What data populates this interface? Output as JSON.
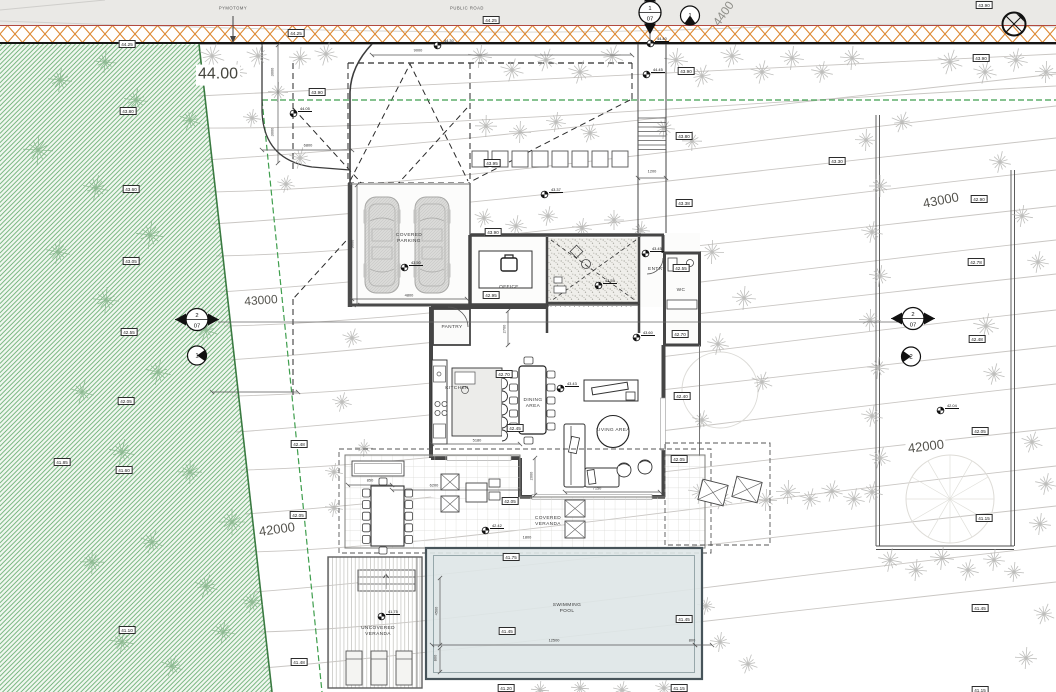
{
  "road": {
    "label_top": "PYMOTOMY",
    "label_public_road": "PUBLIC ROAD"
  },
  "contour_labels": [
    {
      "text": "44.00",
      "x": 218,
      "y": 75,
      "size": 16,
      "rot": 0,
      "color": "#46463f",
      "bg": true
    },
    {
      "text": "43000",
      "x": 261,
      "y": 301,
      "size": 12,
      "rot": -4,
      "color": "#55544e",
      "bg": true
    },
    {
      "text": "43000",
      "x": 941,
      "y": 201,
      "size": 13,
      "rot": -11,
      "color": "#55544e",
      "bg": true
    },
    {
      "text": "42000",
      "x": 277,
      "y": 530,
      "size": 13,
      "rot": -8,
      "color": "#55544e",
      "bg": true
    },
    {
      "text": "42000",
      "x": 926,
      "y": 447,
      "size": 13,
      "rot": -7,
      "color": "#55544e",
      "bg": true
    },
    {
      "text": "4400",
      "x": 724,
      "y": 14,
      "size": 12,
      "rot": -55,
      "color": "#8e8e88",
      "bg": false
    }
  ],
  "rooms": [
    {
      "label": "COVERED\nPARKING",
      "x": 409,
      "y": 239
    },
    {
      "label": "OFFICE",
      "x": 509,
      "y": 288
    },
    {
      "label": "ENTRY",
      "x": 657,
      "y": 270
    },
    {
      "label": "WC",
      "x": 681,
      "y": 291
    },
    {
      "label": "PANTRY",
      "x": 452,
      "y": 328
    },
    {
      "label": "KITCHEN",
      "x": 457,
      "y": 389
    },
    {
      "label": "DINING\nAREA",
      "x": 533,
      "y": 404
    },
    {
      "label": "LIVING AREA",
      "x": 613,
      "y": 431
    },
    {
      "label": "COVERED\nVERANDA",
      "x": 548,
      "y": 522
    },
    {
      "label": "SWIMMING\nPOOL",
      "x": 567,
      "y": 609
    },
    {
      "label": "UNCOVERED\nVERANDA",
      "x": 378,
      "y": 632
    }
  ],
  "spot_elevations": [
    {
      "v": "44.30",
      "x": 437,
      "y": 45
    },
    {
      "v": "44.40",
      "x": 650,
      "y": 43
    },
    {
      "v": "44.45",
      "x": 646,
      "y": 74
    },
    {
      "v": "44.05",
      "x": 293,
      "y": 113
    },
    {
      "v": "43.37",
      "x": 544,
      "y": 194
    },
    {
      "v": "43.50",
      "x": 404,
      "y": 267
    },
    {
      "v": "43.45",
      "x": 645,
      "y": 253
    },
    {
      "v": "43.55",
      "x": 598,
      "y": 285
    },
    {
      "v": "43.60",
      "x": 636,
      "y": 337
    },
    {
      "v": "43.43",
      "x": 560,
      "y": 388
    },
    {
      "v": "42.42",
      "x": 485,
      "y": 530
    },
    {
      "v": "41.75",
      "x": 381,
      "y": 616
    },
    {
      "v": "42.04",
      "x": 940,
      "y": 410
    }
  ],
  "elevation_markers": [
    {
      "v": "44.25",
      "x": 127,
      "y": 44
    },
    {
      "v": "44.25",
      "x": 296,
      "y": 33
    },
    {
      "v": "44.25",
      "x": 491,
      "y": 20
    },
    {
      "v": "43.90",
      "x": 686,
      "y": 71
    },
    {
      "v": "43.90",
      "x": 981,
      "y": 58
    },
    {
      "v": "43.90",
      "x": 984,
      "y": 5
    },
    {
      "v": "43.80",
      "x": 128,
      "y": 111
    },
    {
      "v": "43.60",
      "x": 131,
      "y": 189
    },
    {
      "v": "43.05",
      "x": 131,
      "y": 261
    },
    {
      "v": "42.55",
      "x": 129,
      "y": 332
    },
    {
      "v": "42.05",
      "x": 126,
      "y": 401
    },
    {
      "v": "41.60",
      "x": 124,
      "y": 470
    },
    {
      "v": "41.10",
      "x": 127,
      "y": 630
    },
    {
      "v": "41.85",
      "x": 62,
      "y": 462
    },
    {
      "v": "43.90",
      "x": 317,
      "y": 92
    },
    {
      "v": "43.95",
      "x": 492,
      "y": 163
    },
    {
      "v": "43.90",
      "x": 493,
      "y": 232
    },
    {
      "v": "42.95",
      "x": 491,
      "y": 295
    },
    {
      "v": "43.80",
      "x": 684,
      "y": 136
    },
    {
      "v": "43.38",
      "x": 684,
      "y": 203
    },
    {
      "v": "42.55",
      "x": 681,
      "y": 268
    },
    {
      "v": "42.70",
      "x": 680,
      "y": 334
    },
    {
      "v": "42.70",
      "x": 504,
      "y": 374
    },
    {
      "v": "42.45",
      "x": 515,
      "y": 428
    },
    {
      "v": "42.40",
      "x": 682,
      "y": 396
    },
    {
      "v": "42.05",
      "x": 679,
      "y": 459
    },
    {
      "v": "42.05",
      "x": 510,
      "y": 501
    },
    {
      "v": "41.75",
      "x": 511,
      "y": 557
    },
    {
      "v": "41.45",
      "x": 507,
      "y": 631
    },
    {
      "v": "41.45",
      "x": 684,
      "y": 619
    },
    {
      "v": "41.20",
      "x": 506,
      "y": 688
    },
    {
      "v": "41.15",
      "x": 679,
      "y": 688
    },
    {
      "v": "43.30",
      "x": 837,
      "y": 161
    },
    {
      "v": "42.90",
      "x": 979,
      "y": 199
    },
    {
      "v": "42.78",
      "x": 976,
      "y": 262
    },
    {
      "v": "42.48",
      "x": 977,
      "y": 339
    },
    {
      "v": "42.05",
      "x": 980,
      "y": 431
    },
    {
      "v": "41.15",
      "x": 984,
      "y": 518
    },
    {
      "v": "41.45",
      "x": 980,
      "y": 608
    },
    {
      "v": "41.15",
      "x": 980,
      "y": 690
    },
    {
      "v": "42.48",
      "x": 299,
      "y": 444
    },
    {
      "v": "42.05",
      "x": 298,
      "y": 515
    },
    {
      "v": "41.48",
      "x": 299,
      "y": 662
    }
  ],
  "dims": [
    {
      "t": "9000",
      "x": 418,
      "y": 50,
      "r": 0
    },
    {
      "t": "3000",
      "x": 272,
      "y": 72,
      "r": -90
    },
    {
      "t": "3000",
      "x": 272,
      "y": 132,
      "r": -90
    },
    {
      "t": "6800",
      "x": 308,
      "y": 145,
      "r": 0
    },
    {
      "t": "9000",
      "x": 352,
      "y": 244,
      "r": -90
    },
    {
      "t": "4800",
      "x": 409,
      "y": 295,
      "r": 0
    },
    {
      "t": "1200",
      "x": 652,
      "y": 171,
      "r": 0
    },
    {
      "t": "2700",
      "x": 504,
      "y": 329,
      "r": -90
    },
    {
      "t": "5180",
      "x": 477,
      "y": 440,
      "r": 0
    },
    {
      "t": "7150",
      "x": 597,
      "y": 488,
      "r": 0
    },
    {
      "t": "850",
      "x": 370,
      "y": 480,
      "r": 0
    },
    {
      "t": "6200",
      "x": 434,
      "y": 485,
      "r": 0
    },
    {
      "t": "2000",
      "x": 531,
      "y": 476,
      "r": -90
    },
    {
      "t": "1800",
      "x": 527,
      "y": 537,
      "r": 0
    },
    {
      "t": "12500",
      "x": 554,
      "y": 640,
      "r": 0
    },
    {
      "t": "800",
      "x": 692,
      "y": 640,
      "r": 0
    },
    {
      "t": "4500",
      "x": 436,
      "y": 611,
      "r": -90
    },
    {
      "t": "800",
      "x": 435,
      "y": 658,
      "r": -90
    }
  ],
  "section_markers": [
    {
      "num": "1",
      "sheet": "07",
      "x": 650,
      "y": 15,
      "orient": "v"
    },
    {
      "num": "2",
      "sheet": "07",
      "x": 197,
      "y": 322,
      "orient": "h"
    },
    {
      "num": "2",
      "sheet": "07",
      "x": 913,
      "y": 321,
      "orient": "h"
    }
  ],
  "detail_markers": [
    {
      "num": "1",
      "x": 690,
      "y": 18,
      "wedge": "bottom"
    },
    {
      "num": "1",
      "x": 197,
      "y": 358,
      "wedge": "right"
    },
    {
      "num": "2",
      "x": 911,
      "y": 359,
      "wedge": "left"
    }
  ],
  "colors": {
    "road_hatch": "#dd8a35",
    "boundary_red": "#b24a40",
    "green_hatch": "#63aa6c",
    "setback_green": "#3f9e4d",
    "pool_fill": "#dee6e7",
    "wall": "#454545",
    "tree_gray": "#b3b3b0"
  }
}
